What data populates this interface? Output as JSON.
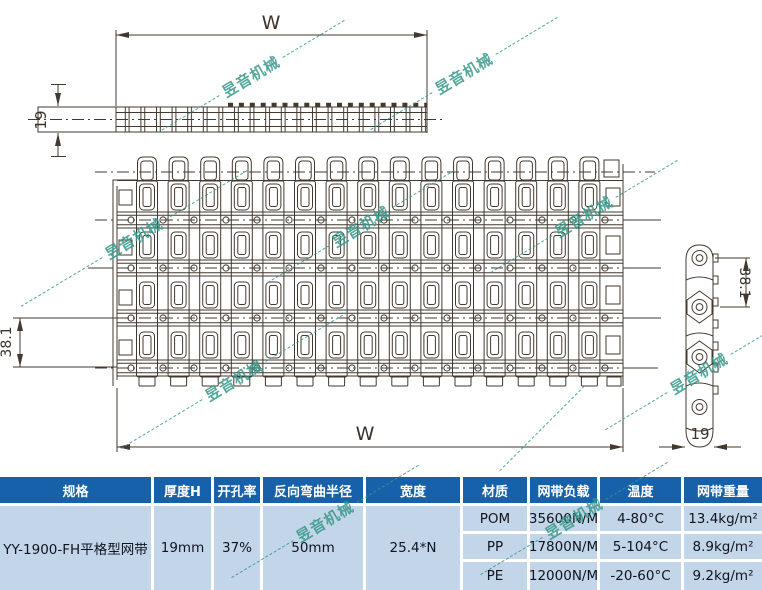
{
  "watermark": {
    "text": "昱音机械"
  },
  "drawing": {
    "dim_w_top": "W",
    "dim_thickness_top": "19",
    "dim_pitch_left": "38.1",
    "dim_w_bottom": "W",
    "dim_pitch_right": "38.1",
    "dim_thickness_side": "19"
  },
  "table": {
    "headers": [
      "规格",
      "厚度H",
      "开孔率",
      "反向弯曲半径",
      "宽度",
      "材质",
      "网带负载",
      "温度",
      "网带重量"
    ],
    "spec": {
      "model": "YY-1900-FH平格型网带",
      "thickness_h": "19mm",
      "open_area": "37%",
      "back_bend_radius": "50mm",
      "width": "25.4*N"
    },
    "materials": [
      {
        "name": "POM",
        "load": "35600N/M",
        "temperature": "4-80°C",
        "weight": "13.4kg/m²"
      },
      {
        "name": "PP",
        "load": "17800N/M",
        "temperature": "5-104°C",
        "weight": "8.9kg/m²"
      },
      {
        "name": "PE",
        "load": "12000N/M",
        "temperature": "-20-60°C",
        "weight": "9.2kg/m²"
      }
    ]
  },
  "colors": {
    "header_blue": "#1661a9",
    "cell_blue": "#c2d5e9",
    "line_color": "#44392f",
    "watermark_green": "#38998a"
  }
}
